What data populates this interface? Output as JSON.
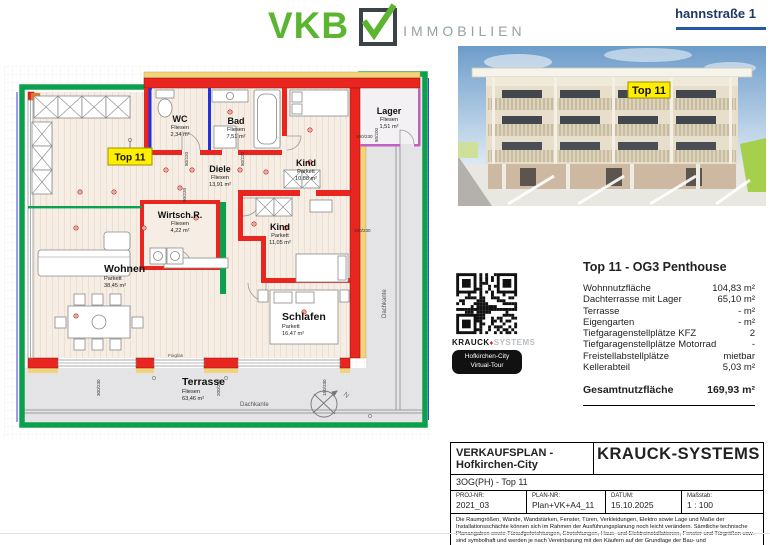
{
  "header": {
    "vkb": "VKB",
    "immobilien": "IMMOBILIEN",
    "address": "hannstraße 1"
  },
  "photo": {
    "unit_label": "Top 11"
  },
  "plan": {
    "top_label": "Top 11",
    "rooms": [
      {
        "name": "WC",
        "floor": "Fliesen",
        "area": "2,34 m²"
      },
      {
        "name": "Bad",
        "floor": "Fliesen",
        "area": "7,51 m²"
      },
      {
        "name": "Lager",
        "floor": "Fliesen",
        "area": "1,51 m²"
      },
      {
        "name": "Kind",
        "floor": "Parkett",
        "area": "10,88 m²"
      },
      {
        "name": "Diele",
        "floor": "Fliesen",
        "area": "13,91 m²"
      },
      {
        "name": "Wirtsch.R.",
        "floor": "Fliesen",
        "area": "4,22 m²"
      },
      {
        "name": "Kind",
        "floor": "Parkett",
        "area": "11,05 m²"
      },
      {
        "name": "Wohnen",
        "floor": "Parkett",
        "area": "38,45 m²"
      },
      {
        "name": "Schlafen",
        "floor": "Parkett",
        "area": "16,47 m²"
      },
      {
        "name": "Terrasse",
        "floor": "Fliesen",
        "area": "63,46 m²"
      }
    ],
    "dims": [
      "80/220",
      "80/220",
      "80/220",
      "100/230",
      "80/200",
      "100/230",
      "300/230",
      "200/230",
      "150/230"
    ],
    "annotations": {
      "dachkante_right": "Dachkante",
      "dachkante_bottom": "Dachkante",
      "fixglas": "Fixglas",
      "north": "N"
    },
    "colors": {
      "wall": "#e8251f",
      "terrace_edge": "#0ca04e",
      "insulation": "#f0d37c",
      "plumbing": "#2233dd",
      "lager_wall": "#c060c0"
    }
  },
  "qr": {
    "brand_black": "KRAUCK",
    "brand_gray": "SYSTEMS",
    "badge_line1": "Hofkirchen-City",
    "badge_line2": "Virtual-Tour"
  },
  "details": {
    "title": "Top 11 - OG3 Penthouse",
    "rows": [
      {
        "label": "Wohnnutzfläche",
        "value": "104,83 m²"
      },
      {
        "label": "Dachterrasse mit Lager",
        "value": "65,10 m²"
      },
      {
        "label": "Terrasse",
        "value": "- m²"
      },
      {
        "label": "Eigengarten",
        "value": "- m²"
      },
      {
        "label": "Tiefgaragenstellplätze KFZ",
        "value": "2"
      },
      {
        "label": "Tiefgaragenstellplätze Motorrad",
        "value": "-"
      },
      {
        "label": "Freistellabstellplätze",
        "value": "mietbar"
      },
      {
        "label": "Kellerabteil",
        "value": "5,03 m²"
      }
    ],
    "total_label": "Gesamtnutzfläche",
    "total_value": "169,93 m²"
  },
  "titleblock": {
    "plan_title": "VERKAUFSPLAN - Hofkirchen-City",
    "company": "KRAUCK-SYSTEMS",
    "subtitle": "3OG(PH) - Top 11",
    "fields": [
      {
        "label": "PROJ-NR:",
        "value": "2021_03"
      },
      {
        "label": "PLAN-NR:",
        "value": "Plan+VK+A4_11"
      },
      {
        "label": "DATUM:",
        "value": "15.10.2025"
      },
      {
        "label": "Maßstab:",
        "value": "1 : 100"
      }
    ],
    "disclaimer": "Die Raumgrößen, Wände, Wandstärken, Fenster, Türen, Verkleidungen, Elektro sowie Lage und Maße der Installationsschächte können sich im Rahmen der Ausführungsplanung noch leicht verändern. Sämtliche technische Planangaben sowie Türaufgehrichtungen, Einrichtungen, Haus- und Elektroinstallationen, Fenster und Türgrößen usw. sind symbolhaft und werden je nach Vereinbarung mit den Käufern auf der Grundlage der Bau- und Ausstattungsbeschreibung ausgeführt."
  }
}
